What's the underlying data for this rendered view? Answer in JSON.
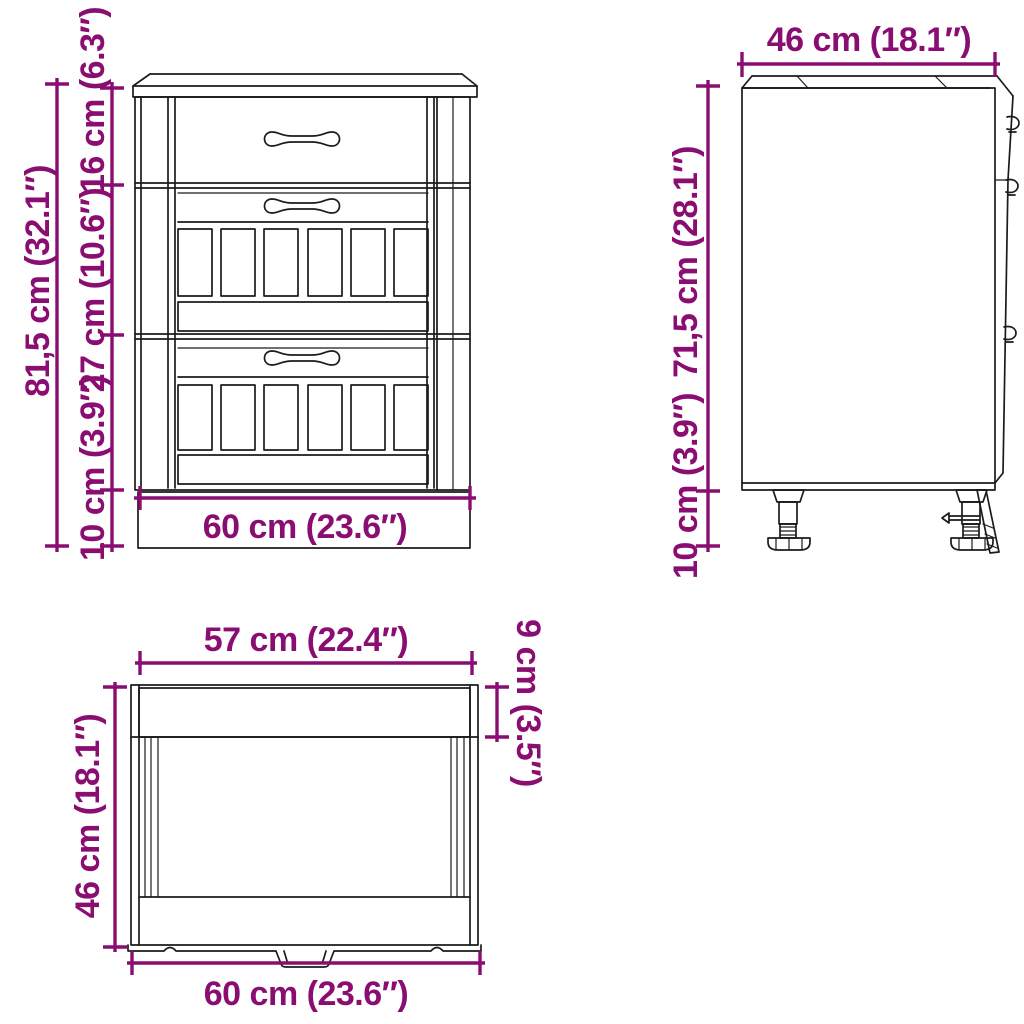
{
  "colors": {
    "accent": "#8a0d72",
    "line_art": "#1b1b1b",
    "background": "#ffffff"
  },
  "front_view": {
    "total_height": "81,5 cm (32.1″)",
    "top_drawer_height": "16 cm (6.3″)",
    "middle_drawer_height": "27 cm (10.6″)",
    "plinth_height": "10 cm (3.9″)",
    "width": "60 cm (23.6″)"
  },
  "side_view": {
    "depth": "46 cm (18.1″)",
    "carcass_height": "71,5 cm (28.1″)",
    "leg_height": "10 cm (3.9″)"
  },
  "top_view": {
    "inner_width": "57 cm (22.4″)",
    "worktop_depth": "9 cm (3.5″)",
    "depth": "46 cm (18.1″)",
    "total_width": "60 cm (23.6″)"
  }
}
